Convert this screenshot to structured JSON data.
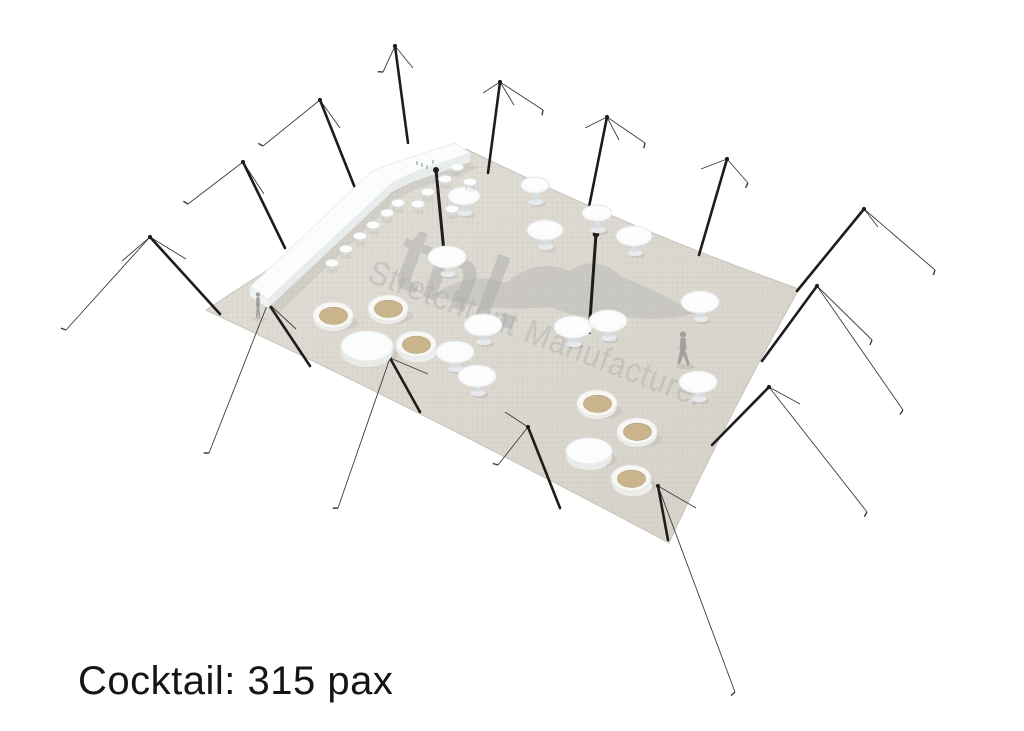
{
  "caption": {
    "text": "Cocktail: 315 pax",
    "color": "#151515"
  },
  "watermark": {
    "logo": "tnl.",
    "tagline": "Stretchtent Manufacturer",
    "color": "#adadad",
    "logo_opacity": 0.5,
    "tagline_opacity": 0.45,
    "angle": 20.8,
    "logo_pos": [
      388,
      283
    ],
    "tagline_pos": [
      366,
      281
    ],
    "tagline_length": 358
  },
  "scene": {
    "size": [
      1024,
      731
    ],
    "colors": {
      "pole": "#1d1d1d",
      "rope": "#3c3c3c",
      "white": "#fbfcfc",
      "white_edge": "#e7eaea",
      "shade": "#e9ecec",
      "pedestal": "#d9dee1",
      "base": "#e6eaec",
      "tub_tan": "#c9b48c",
      "tub_tan_edge": "#b6a27c",
      "floor_light": "#e2dfd8",
      "floor_dark": "#d6d2c9",
      "floor_edge": "#c9c5bc",
      "texture": "#b2ae a2",
      "person": "#a0a0a0",
      "shadow": "rgba(100,100,90,0.10)"
    },
    "floor_path": "M206,310 Q340,222 466,149 Q628,228 799,289 Q724,424 669,543 Q430,415 206,310 Z",
    "swoosh_path": "M432,296 Q468,270 506,283 Q536,257 570,271 Q596,253 622,277 Q658,291 696,313 Q660,323 622,316 Q586,322 550,307 Q500,311 462,304 Z",
    "perimeter_poles": [
      {
        "pole": [
          150,
          237,
          220,
          314
        ],
        "guys": [
          {
            "to": [
              66,
              330
            ],
            "tick": true
          },
          {
            "to": [
              186,
              259
            ]
          },
          {
            "to": [
              122,
              261
            ]
          }
        ]
      },
      {
        "pole": [
          243,
          162,
          285,
          248
        ],
        "guys": [
          {
            "to": [
              188,
              204
            ],
            "tick": true
          },
          {
            "to": [
              264,
              194
            ]
          }
        ]
      },
      {
        "pole": [
          320,
          100,
          355,
          188
        ],
        "guys": [
          {
            "to": [
              263,
              146
            ],
            "tick": true
          },
          {
            "to": [
              340,
              128
            ]
          }
        ]
      },
      {
        "pole": [
          395,
          46,
          408,
          143
        ],
        "guys": [
          {
            "to": [
              383,
              72
            ],
            "tick": true
          },
          {
            "to": [
              413,
              68
            ]
          }
        ]
      },
      {
        "pole": [
          500,
          82,
          488,
          173
        ],
        "guys": [
          {
            "to": [
              483,
              93
            ]
          },
          {
            "to": [
              543,
              110
            ],
            "tick": true
          },
          {
            "to": [
              514,
              105
            ]
          }
        ]
      },
      {
        "pole": [
          607,
          117,
          588,
          212
        ],
        "guys": [
          {
            "to": [
              585,
              128
            ]
          },
          {
            "to": [
              645,
              143
            ],
            "tick": true
          },
          {
            "to": [
              619,
              140
            ]
          }
        ]
      },
      {
        "pole": [
          727,
          159,
          699,
          255
        ],
        "guys": [
          {
            "to": [
              701,
              169
            ]
          },
          {
            "to": [
              748,
              183
            ],
            "tick": true
          }
        ]
      },
      {
        "pole": [
          864,
          209,
          797,
          291
        ],
        "guys": [
          {
            "to": [
              935,
              270
            ],
            "tick": true
          },
          {
            "to": [
              840,
              237
            ]
          },
          {
            "to": [
              878,
              227
            ]
          }
        ]
      },
      {
        "pole": [
          817,
          286,
          762,
          361
        ],
        "guys": [
          {
            "to": [
              872,
              340
            ],
            "tick": true
          },
          {
            "to": [
              903,
              410
            ],
            "tick": true
          }
        ]
      },
      {
        "pole": [
          769,
          387,
          712,
          445
        ],
        "guys": [
          {
            "to": [
              867,
              512
            ],
            "tick": true
          },
          {
            "to": [
              800,
              404
            ]
          }
        ]
      },
      {
        "pole": [
          658,
          486,
          668,
          540
        ],
        "guys": [
          {
            "to": [
              735,
              692
            ],
            "tick": true
          },
          {
            "to": [
              696,
              508
            ]
          }
        ]
      },
      {
        "pole": [
          528,
          427,
          560,
          508
        ],
        "guys": [
          {
            "to": [
              505,
              412
            ]
          },
          {
            "to": [
              498,
              465
            ],
            "tick": true
          }
        ]
      },
      {
        "pole": [
          390,
          358,
          420,
          412
        ],
        "guys": [
          {
            "to": [
              338,
              508
            ],
            "tick": true
          },
          {
            "to": [
              428,
              374
            ]
          }
        ]
      },
      {
        "pole": [
          268,
          303,
          310,
          366
        ],
        "guys": [
          {
            "to": [
              209,
              453
            ],
            "tick": true
          },
          {
            "to": [
              296,
              329
            ]
          }
        ]
      }
    ],
    "interior_poles": [
      {
        "pole": [
          436,
          170,
          444,
          252
        ],
        "ball": 3.0
      },
      {
        "pole": [
          596,
          234,
          589,
          334
        ],
        "ball": 3.3
      }
    ],
    "bar": {
      "shadow": "M268,308 L392,192 L412,182 L470,162 L478,168 L414,190 L396,200 L276,316 Z",
      "front": "M268,299 L392,183 L412,173 L470,153 L470,162 L412,182 L392,192 L268,308 Z",
      "endcap": "M250,287 L268,299 L268,308 L250,296 Z",
      "top": "M250,287 L372,171 L396,162 L455,143 L470,153 L412,173 L392,183 L268,299 Z",
      "items": [
        [
          417,
          164
        ],
        [
          422,
          166
        ],
        [
          427,
          168
        ],
        [
          433,
          163
        ]
      ]
    },
    "stools": [
      [
        332,
        263
      ],
      [
        346,
        249
      ],
      [
        360,
        236
      ],
      [
        373,
        225
      ],
      [
        387,
        213
      ],
      [
        398,
        203
      ],
      [
        418,
        204
      ],
      [
        428,
        192
      ],
      [
        445,
        179
      ],
      [
        457,
        167
      ],
      [
        452,
        209
      ],
      [
        470,
        182
      ]
    ],
    "cocktail_tables": [
      {
        "c": [
          447,
          257
        ],
        "rx": 19,
        "ry": 11
      },
      {
        "c": [
          483,
          325
        ],
        "rx": 19,
        "ry": 11
      },
      {
        "c": [
          455,
          352
        ],
        "rx": 19,
        "ry": 11
      },
      {
        "c": [
          477,
          376
        ],
        "rx": 19,
        "ry": 11
      },
      {
        "c": [
          573,
          327
        ],
        "rx": 19,
        "ry": 11
      },
      {
        "c": [
          608,
          321
        ],
        "rx": 19,
        "ry": 11
      },
      {
        "c": [
          545,
          230
        ],
        "rx": 18,
        "ry": 10
      },
      {
        "c": [
          634,
          236
        ],
        "rx": 18,
        "ry": 10
      },
      {
        "c": [
          700,
          302
        ],
        "rx": 19,
        "ry": 11
      },
      {
        "c": [
          698,
          382
        ],
        "rx": 19,
        "ry": 11
      },
      {
        "c": [
          464,
          196
        ],
        "rx": 16,
        "ry": 9
      },
      {
        "c": [
          535,
          185
        ],
        "rx": 14,
        "ry": 8
      },
      {
        "c": [
          597,
          213
        ],
        "rx": 15,
        "ry": 8
      }
    ],
    "drum_tables": [
      {
        "c": [
          367,
          346
        ],
        "rx": 26,
        "ry": 15
      },
      {
        "c": [
          589,
          451
        ],
        "rx": 23,
        "ry": 13
      }
    ],
    "tub_tables": [
      {
        "c": [
          333,
          315
        ],
        "saucer": false
      },
      {
        "c": [
          388,
          308
        ],
        "saucer": false
      },
      {
        "c": [
          416,
          344
        ],
        "saucer": true
      },
      {
        "c": [
          597,
          403
        ],
        "saucer": false
      },
      {
        "c": [
          637,
          431
        ],
        "saucer": false
      },
      {
        "c": [
          631,
          478
        ],
        "saucer": true
      }
    ],
    "people": [
      {
        "x": 258,
        "y": 318,
        "h": 26,
        "pose": "stand"
      },
      {
        "x": 683,
        "y": 365,
        "h": 34,
        "pose": "walk"
      }
    ]
  }
}
